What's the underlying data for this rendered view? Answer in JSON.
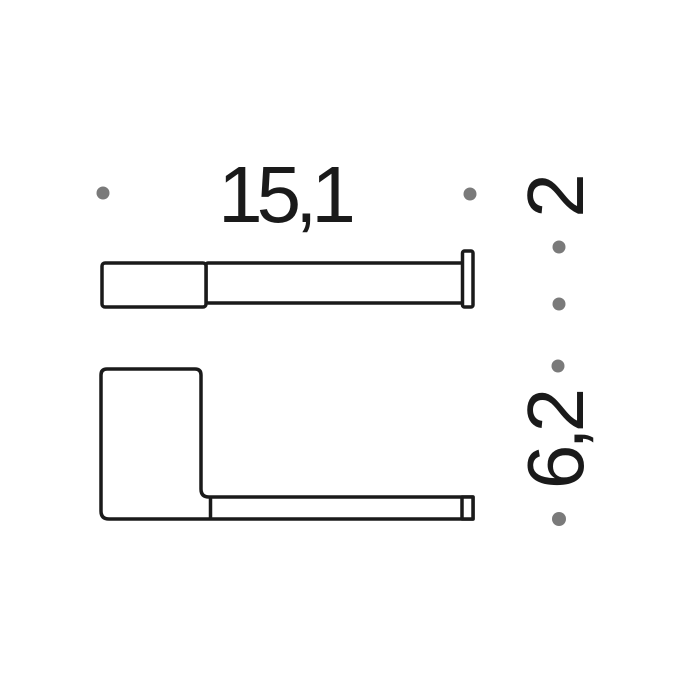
{
  "drawing": {
    "description": "Technical dimension drawing, two orthographic views of a wall-mounted bathroom bar holder",
    "dimension_labels": {
      "width": "15,1",
      "depth": "2",
      "height": "6,2"
    },
    "colors": {
      "line": "#1a1a1a",
      "text": "#1a1a1a",
      "reference_dot": "#7a7a7a",
      "background": "#ffffff"
    }
  }
}
